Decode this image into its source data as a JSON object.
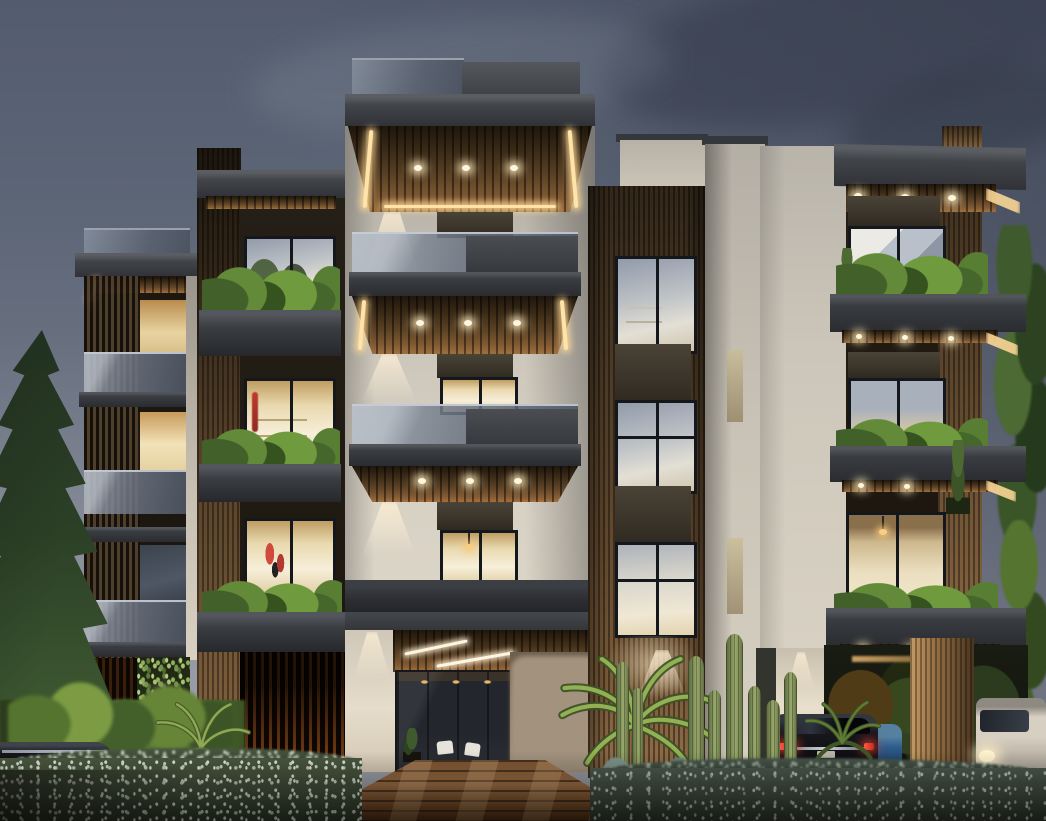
{
  "scene": {
    "type": "architectural-exterior-rendering",
    "time_of_day": "dusk",
    "subject": "Photorealistic visualization of a modern four-storey apartment building with white plaster volumes, vertical timber cladding, dark grey cantilevered balcony slabs, wood slat soffits with strip and spot lighting, planted balcony boxes, glass balustrades, a lit timber-deck entrance walkway, a carport with parked cars and lush dusk landscaping",
    "no_visible_text": true,
    "erased_area_note": "rectangular beige patch near entrance where signage/watermark was removed"
  },
  "palette": {
    "sky_top": "#535c6e",
    "sky_mid": "#6f7685",
    "sky_low": "#989ba4",
    "cloud_dark": "#3f4655",
    "wall_light": "#d9d3c7",
    "wall_shadow": "#9e998f",
    "slab_dark": "#393c41",
    "slab_deep": "#2a2c30",
    "glass_rail": "#7b8494",
    "wood_light": "#96714a",
    "wood_dark": "#3e2f1f",
    "led_warm": "#ffe3a8",
    "downlight": "#fff6dd",
    "window_warm": "#f2e4c0",
    "window_bright": "#f7efda",
    "window_cool": "#b9bfc7",
    "stone_spandrel": "#423b2f",
    "foliage_light": "#7f9c45",
    "foliage_dark": "#2c3e24",
    "hedge_flowers": "#d6ded0",
    "deck_light": "#9c6e44",
    "car_black": "#16161a",
    "car_taillight": "#d23a30",
    "car_white": "#d3ccc0",
    "car_blue": "#33618f",
    "erased_patch": "#a2927e"
  },
  "objects": {
    "building": {
      "left_wing": "timber louvre tower with glass roof parapet, three glass balustrade balconies, warm lit windows, backlit ground slats and vertical garden",
      "left_tower": "timber pier with dark canopy and three planter balconies; interiors show shelves and red artwork",
      "center_tower": "tallest white volume with roof parapet, large cantilevered canopy with slatted soffit and three downlights, two balcony levels, entrance canopy with linear lights and glass lobby",
      "wood_tower": "vertical timber-clad column with three stacked windows separated by dark stone spandrels",
      "right_wing": "dark canopy with downlights, timber column, three wide planter slabs with edge LED glow, cool and warm lit interiors, carport below"
    },
    "vehicles": [
      "black luxury sedan with lit red tail lamps under carport",
      "blue compact car partially hidden behind sedan",
      "white SUV with lit headlight at far right",
      "dark car with chrome trim behind left hedge"
    ],
    "vegetation": [
      "tall conifer at left edge",
      "leafy trees along right edge",
      "palm plants flanking the walkway",
      "columnar cacti group",
      "fern cluster",
      "shrubs in balcony planter boxes",
      "white-flowering hedge across the foreground",
      "lit lawn strip at left"
    ],
    "hardscape": "timber deck walkway with diagonal light bands leading to the glass entrance lobby"
  }
}
